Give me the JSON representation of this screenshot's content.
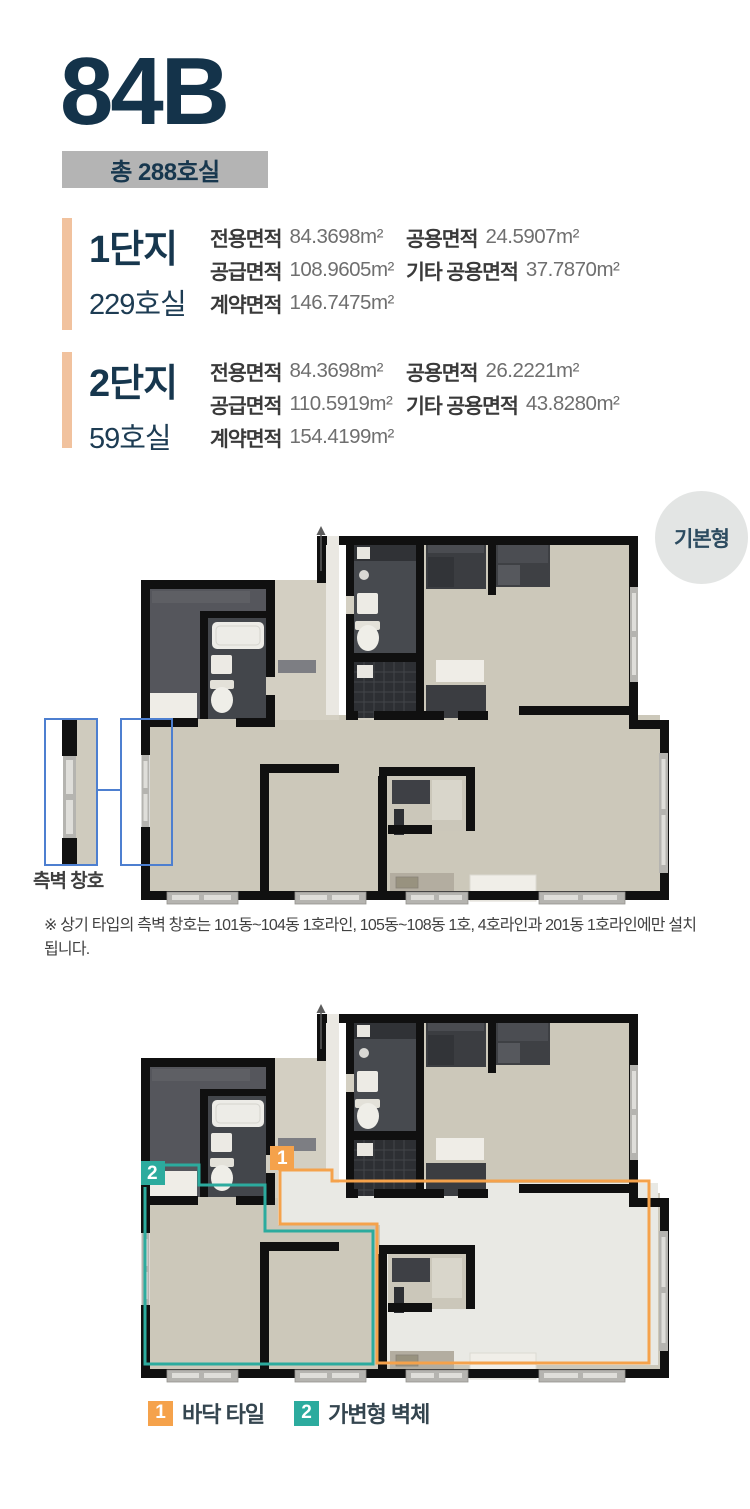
{
  "header": {
    "type_code": "84B",
    "total_units": "총 288호실"
  },
  "sections": [
    {
      "name": "1단지",
      "units": "229호실",
      "col1": [
        {
          "label": "전용면적",
          "value": "84.3698m²"
        },
        {
          "label": "공급면적",
          "value": "108.9605m²"
        },
        {
          "label": "계약면적",
          "value": "146.7475m²"
        }
      ],
      "col2": [
        {
          "label": "공용면적",
          "value": "24.5907m²"
        },
        {
          "label": "기타 공용면적",
          "value": "37.7870m²"
        }
      ]
    },
    {
      "name": "2단지",
      "units": "59호실",
      "col1": [
        {
          "label": "전용면적",
          "value": "84.3698m²"
        },
        {
          "label": "공급면적",
          "value": "110.5919m²"
        },
        {
          "label": "계약면적",
          "value": "154.4199m²"
        }
      ],
      "col2": [
        {
          "label": "공용면적",
          "value": "26.2221m²"
        },
        {
          "label": "기타 공용면적",
          "value": "43.8280m²"
        }
      ]
    }
  ],
  "plan_basic": {
    "badge": "기본형",
    "side_window_label": "측벽 창호",
    "note": "※ 상기 타입의 측벽 창호는 101동~104동 1호라인, 105동~108동 1호, 4호라인과 201동 1호라인에만 설치됩니다."
  },
  "plan_options": {
    "marker1": "1",
    "marker2": "2"
  },
  "legend": {
    "item1_num": "1",
    "item1_label": "바닥 타일",
    "item2_num": "2",
    "item2_label": "가변형 벽체"
  },
  "colors": {
    "navy": "#14334a",
    "badge_bg": "#b4b4b4",
    "peach": "#f1c29e",
    "orange": "#f5a24b",
    "teal": "#2cab9e",
    "annotation_blue": "#4d7fd0",
    "wall": "#101010",
    "wood_floor": "#ccc8ba",
    "tile_floor": "#e9e9e4"
  }
}
